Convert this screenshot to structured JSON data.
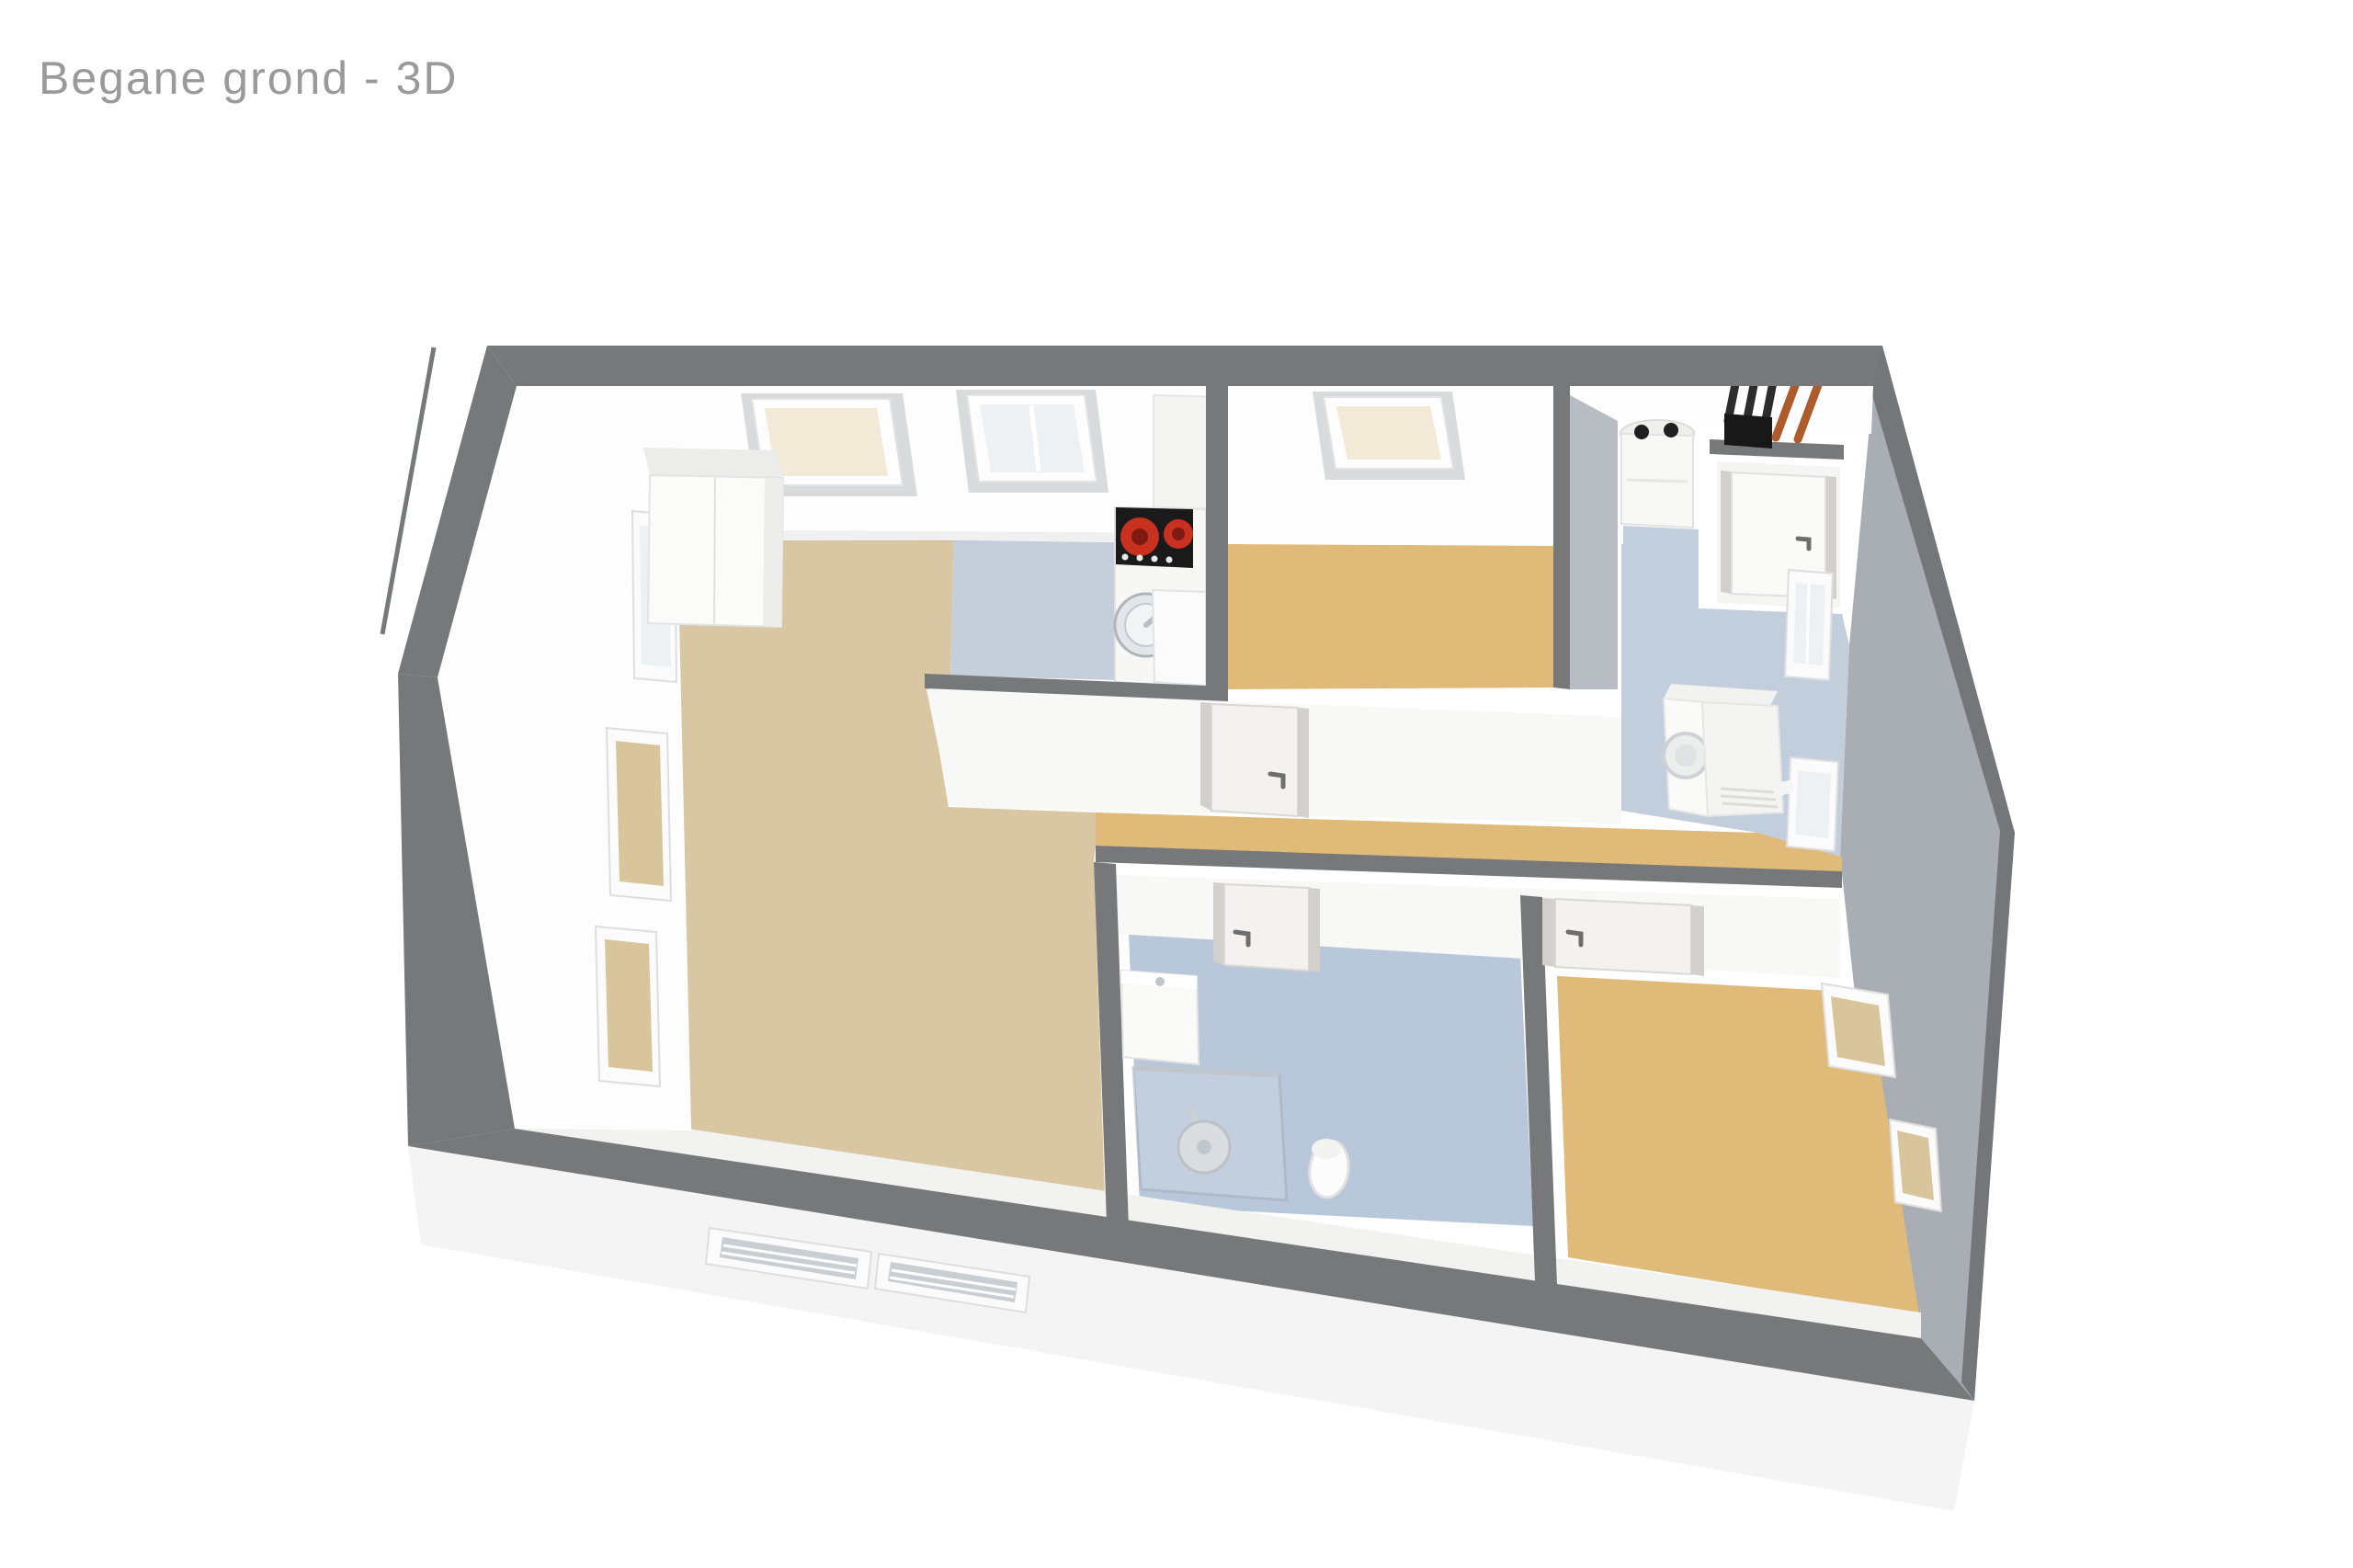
{
  "title": {
    "text": "Begane grond - 3D"
  },
  "colors": {
    "page_bg": "#ffffff",
    "title_text": "#9a9a9a",
    "wall_top": "#77787a",
    "wall_face_right": "#a8aeb4",
    "wall_face_right_rim": "#75767a",
    "wall_shade": "#b7bdc3",
    "floor_living": "#d9c7a4",
    "floor_bedroom": "#dfba79",
    "floor_hall": "#dfba79",
    "floor_kitchen": "#c5cfdc",
    "floor_utility": "#c3cedd",
    "floor_bath": "#b9c7da",
    "facade": "#f4f4f4",
    "blind_cream": "#f2e9d6",
    "blind_tan": "#d8c59c",
    "window_pane": "#eef1f4",
    "stove_black": "#1a1a1a",
    "burner_red": "#c8301f",
    "burner_core": "#7e1a12",
    "pipe_black": "#2c2c2c",
    "pipe_copper": "#ad5b2c",
    "chrome": "#c0c6cb",
    "louver_slat": "#c9ced2",
    "glass": "#ccd7e2"
  },
  "semantics": {
    "view": "3D top-down floor plan render",
    "rooms": [
      {
        "name": "living room with open kitchen",
        "floor_color_keys": [
          "floor_living",
          "floor_kitchen"
        ]
      },
      {
        "name": "bedroom top-middle",
        "floor_color_keys": [
          "floor_bedroom"
        ]
      },
      {
        "name": "utility hall with boiler closet",
        "floor_color_keys": [
          "floor_utility"
        ]
      },
      {
        "name": "corridor",
        "floor_color_keys": [
          "floor_hall"
        ]
      },
      {
        "name": "bathroom",
        "floor_color_keys": [
          "floor_bath"
        ]
      },
      {
        "name": "bedroom bottom-right",
        "floor_color_keys": [
          "floor_bedroom"
        ]
      }
    ],
    "fixtures": [
      "induction-hob-with-red-burners",
      "round-kitchen-sink",
      "kitchen-counter",
      "tall-cabinet",
      "central-heating-boiler",
      "black-flue-pipes",
      "copper-heating-pipes",
      "closet-door",
      "washing-machine",
      "interior-door-bedroom-1",
      "interior-door-bathroom",
      "interior-door-bedroom-2",
      "shower-with-rain-head",
      "washbasin",
      "toilet",
      "skylight-with-cream-blind",
      "skylight-white",
      "wall-windows-with-tan-blinds",
      "louvre-vent-windows",
      "letterbox-slot"
    ]
  }
}
